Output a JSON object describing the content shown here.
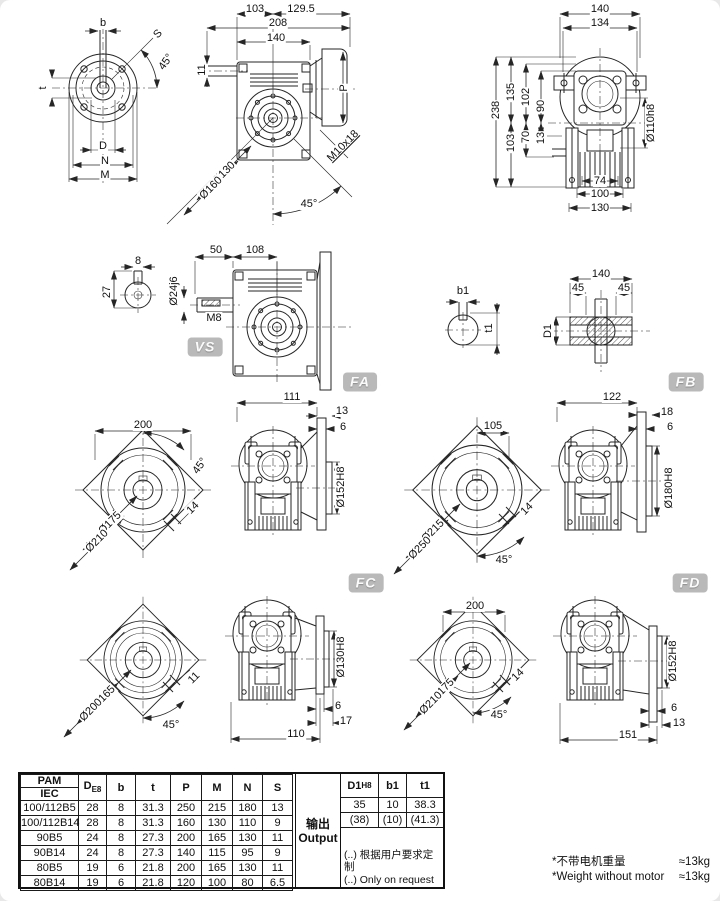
{
  "figures": {
    "shaft_end": {
      "b": "b",
      "t": "t",
      "s": "S",
      "angle": "45°",
      "d": "D",
      "n": "N",
      "m": "M"
    },
    "front_view": {
      "d103": "103",
      "d129_5": "129.5",
      "d208": "208",
      "d140": "140",
      "d11": "11",
      "p": "P",
      "m10x18": "M10x18",
      "dia130": "Ø130",
      "dia160": "Ø160",
      "angle": "45°"
    },
    "rear_view": {
      "d140": "140",
      "d134": "134",
      "d238": "238",
      "d135": "135",
      "d102": "102",
      "d90": "90",
      "d103": "103",
      "d70": "70",
      "d13": "13",
      "dia110": "Ø110h8",
      "d74": "74",
      "d100": "100",
      "d130": "130"
    },
    "key_section": {
      "d8": "8",
      "d27": "27"
    },
    "vs_view": {
      "d50": "50",
      "d108": "108",
      "dia24": "Ø24j6",
      "m8": "M8"
    },
    "output_key": {
      "b1": "b1",
      "t1": "t1"
    },
    "hollow_shaft": {
      "d140": "140",
      "d45l": "45",
      "d45r": "45",
      "d1": "D1"
    },
    "fa_flange": {
      "d200": "200",
      "angle": "45°",
      "dia175": "Ø175",
      "dia210": "Ø210",
      "d14": "14"
    },
    "fa_side": {
      "d111": "111",
      "d13": "13",
      "d6": "6",
      "dia152": "Ø152H8"
    },
    "fb_flange": {
      "d105": "105",
      "dia215": "Ø215",
      "dia250": "Ø250",
      "d14": "14",
      "angle": "45°"
    },
    "fb_side": {
      "d122": "122",
      "d18": "18",
      "d6": "6",
      "dia180": "Ø180H8"
    },
    "fc_flange": {
      "dia165": "Ø165",
      "dia200": "Ø200",
      "d11": "11",
      "angle": "45°"
    },
    "fc_side": {
      "dia130": "Ø130H8",
      "d6": "6",
      "d17": "17",
      "d110": "110"
    },
    "fd_flange": {
      "d200": "200",
      "dia175": "Ø175",
      "dia210": "Ø210",
      "d14": "14",
      "angle": "45°"
    },
    "fd_side": {
      "dia152": "Ø152H8",
      "d6": "6",
      "d13": "13",
      "d151": "151"
    }
  },
  "badges": {
    "vs": "VS",
    "fa": "FA",
    "fb": "FB",
    "fc": "FC",
    "fd": "FD"
  },
  "table": {
    "header": {
      "pam": "PAM",
      "iec": "IEC",
      "d": "D",
      "d_sub": "E8",
      "b": "b",
      "t": "t",
      "p": "P",
      "m": "M",
      "n": "N",
      "s": "S"
    },
    "rows": [
      [
        "100/112B5",
        "28",
        "8",
        "31.3",
        "250",
        "215",
        "180",
        "13"
      ],
      [
        "100/112B14",
        "28",
        "8",
        "31.3",
        "160",
        "130",
        "110",
        "9"
      ],
      [
        "90B5",
        "24",
        "8",
        "27.3",
        "200",
        "165",
        "130",
        "11"
      ],
      [
        "90B14",
        "24",
        "8",
        "27.3",
        "140",
        "115",
        "95",
        "9"
      ],
      [
        "80B5",
        "19",
        "6",
        "21.8",
        "200",
        "165",
        "130",
        "11"
      ],
      [
        "80B14",
        "19",
        "6",
        "21.8",
        "120",
        "100",
        "80",
        "6.5"
      ]
    ],
    "output": {
      "cn": "输出",
      "en": "Output",
      "d1": "D1",
      "d1_sub": "H8",
      "b1": "b1",
      "t1": "t1",
      "rows": [
        [
          "35",
          "10",
          "38.3"
        ],
        [
          "(38)",
          "(10)",
          "(41.3)"
        ]
      ],
      "note_cn": "(..) 根据用户要求定制",
      "note_en": "(..) Only on request"
    }
  },
  "notes": {
    "cn": "*不带电机重量",
    "cn_value": "≈13kg",
    "en": "*Weight without motor",
    "en_value": "≈13kg"
  }
}
